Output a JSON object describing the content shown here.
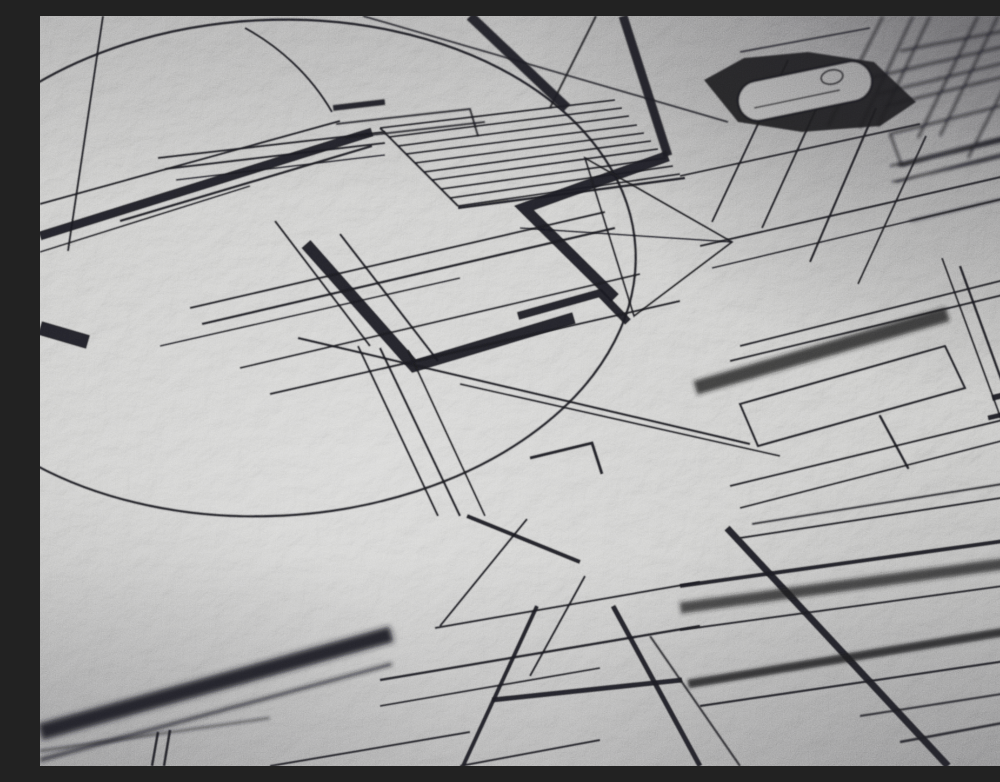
{
  "scene": {
    "description": "Macro photograph of an abstract black-ink technical line drawing printed on textured gray paper, taken at a shallow oblique angle receding toward the upper right, with depth-of-field blur in the near lower-left foreground and far upper-right background",
    "medium": "black ink print on rough-textured gray paper",
    "perspective": "oblique close-up, drawing plane tilted, converging toward upper right",
    "focus": "sharp in the center band, soft blur at lower-left foreground and upper-right distance",
    "lighting": "soft daylight from upper left, bright sheen on center-left paper, heavy shadow vignette in top-right corner",
    "palette": {
      "paper_highlight": "#dcdcda",
      "paper_base": "#c0c0be",
      "paper_shadow": "#8b8a8e",
      "corner_vignette": "#504f55",
      "ink": "#17171a"
    },
    "motifs": [
      {
        "name": "large-ellipse",
        "description": "big thin-line circle of the drawing, foreshortened into a tilted ellipse spanning the left and center"
      },
      {
        "name": "apex-lines",
        "description": "thin straight lines meeting near the top-left, suggesting a triangle apex"
      },
      {
        "name": "hatched-panel",
        "description": "block of ten closely spaced parallel hatch lines in the upper center"
      },
      {
        "name": "stepped-rectangles",
        "description": "nested thin rectangle outlines stepping above the hatched panel"
      },
      {
        "name": "thick-zigzag",
        "description": "heavy black stepped zigzag band in the upper center"
      },
      {
        "name": "open-triangle",
        "description": "thin triangle outline right of the zigzag"
      },
      {
        "name": "thick-corner-band",
        "description": "heavy L-shaped corner band in the center left"
      },
      {
        "name": "capsule-with-eyelet",
        "description": "rounded capsule outline with a small ellipse eyelet, top right"
      },
      {
        "name": "ink-blot-shadow",
        "description": "irregular solid black blot behind the capsule"
      },
      {
        "name": "line-lattice",
        "description": "dense lattice of crossing thin lines over the right half"
      },
      {
        "name": "heavy-diagonal",
        "description": "thick diagonal stroke running to the bottom-right corner"
      },
      {
        "name": "foreground-band",
        "description": "wide blurred black band crossing the lower-left foreground"
      },
      {
        "name": "tick-dashes",
        "description": "short thick dashes at the left edge and right edge"
      }
    ]
  }
}
